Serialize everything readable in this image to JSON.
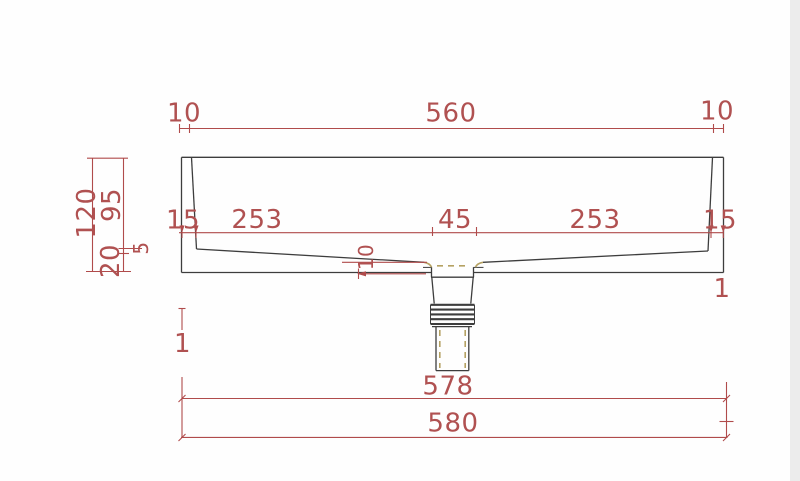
{
  "drawing": {
    "background": "#fefefe",
    "outline_color": "#3d3d3d",
    "dimension_color": "#b04b4b",
    "hidden_line_color": "#b5a263"
  },
  "dimensions": {
    "top": {
      "left_rim": "10",
      "opening": "560",
      "right_rim": "10"
    },
    "interior": {
      "left_wall": "15",
      "left_floor": "253",
      "drain_width": "45",
      "right_floor": "253",
      "right_wall": "15"
    },
    "left": {
      "overall_height": "120",
      "basin_depth": "95",
      "base_thickness": "20",
      "lip": "5"
    },
    "center": {
      "floor_thickness": "10"
    },
    "bottom": {
      "inner_width": "578",
      "overall_width": "580"
    },
    "offsets": {
      "left": "1",
      "right": "1"
    }
  }
}
